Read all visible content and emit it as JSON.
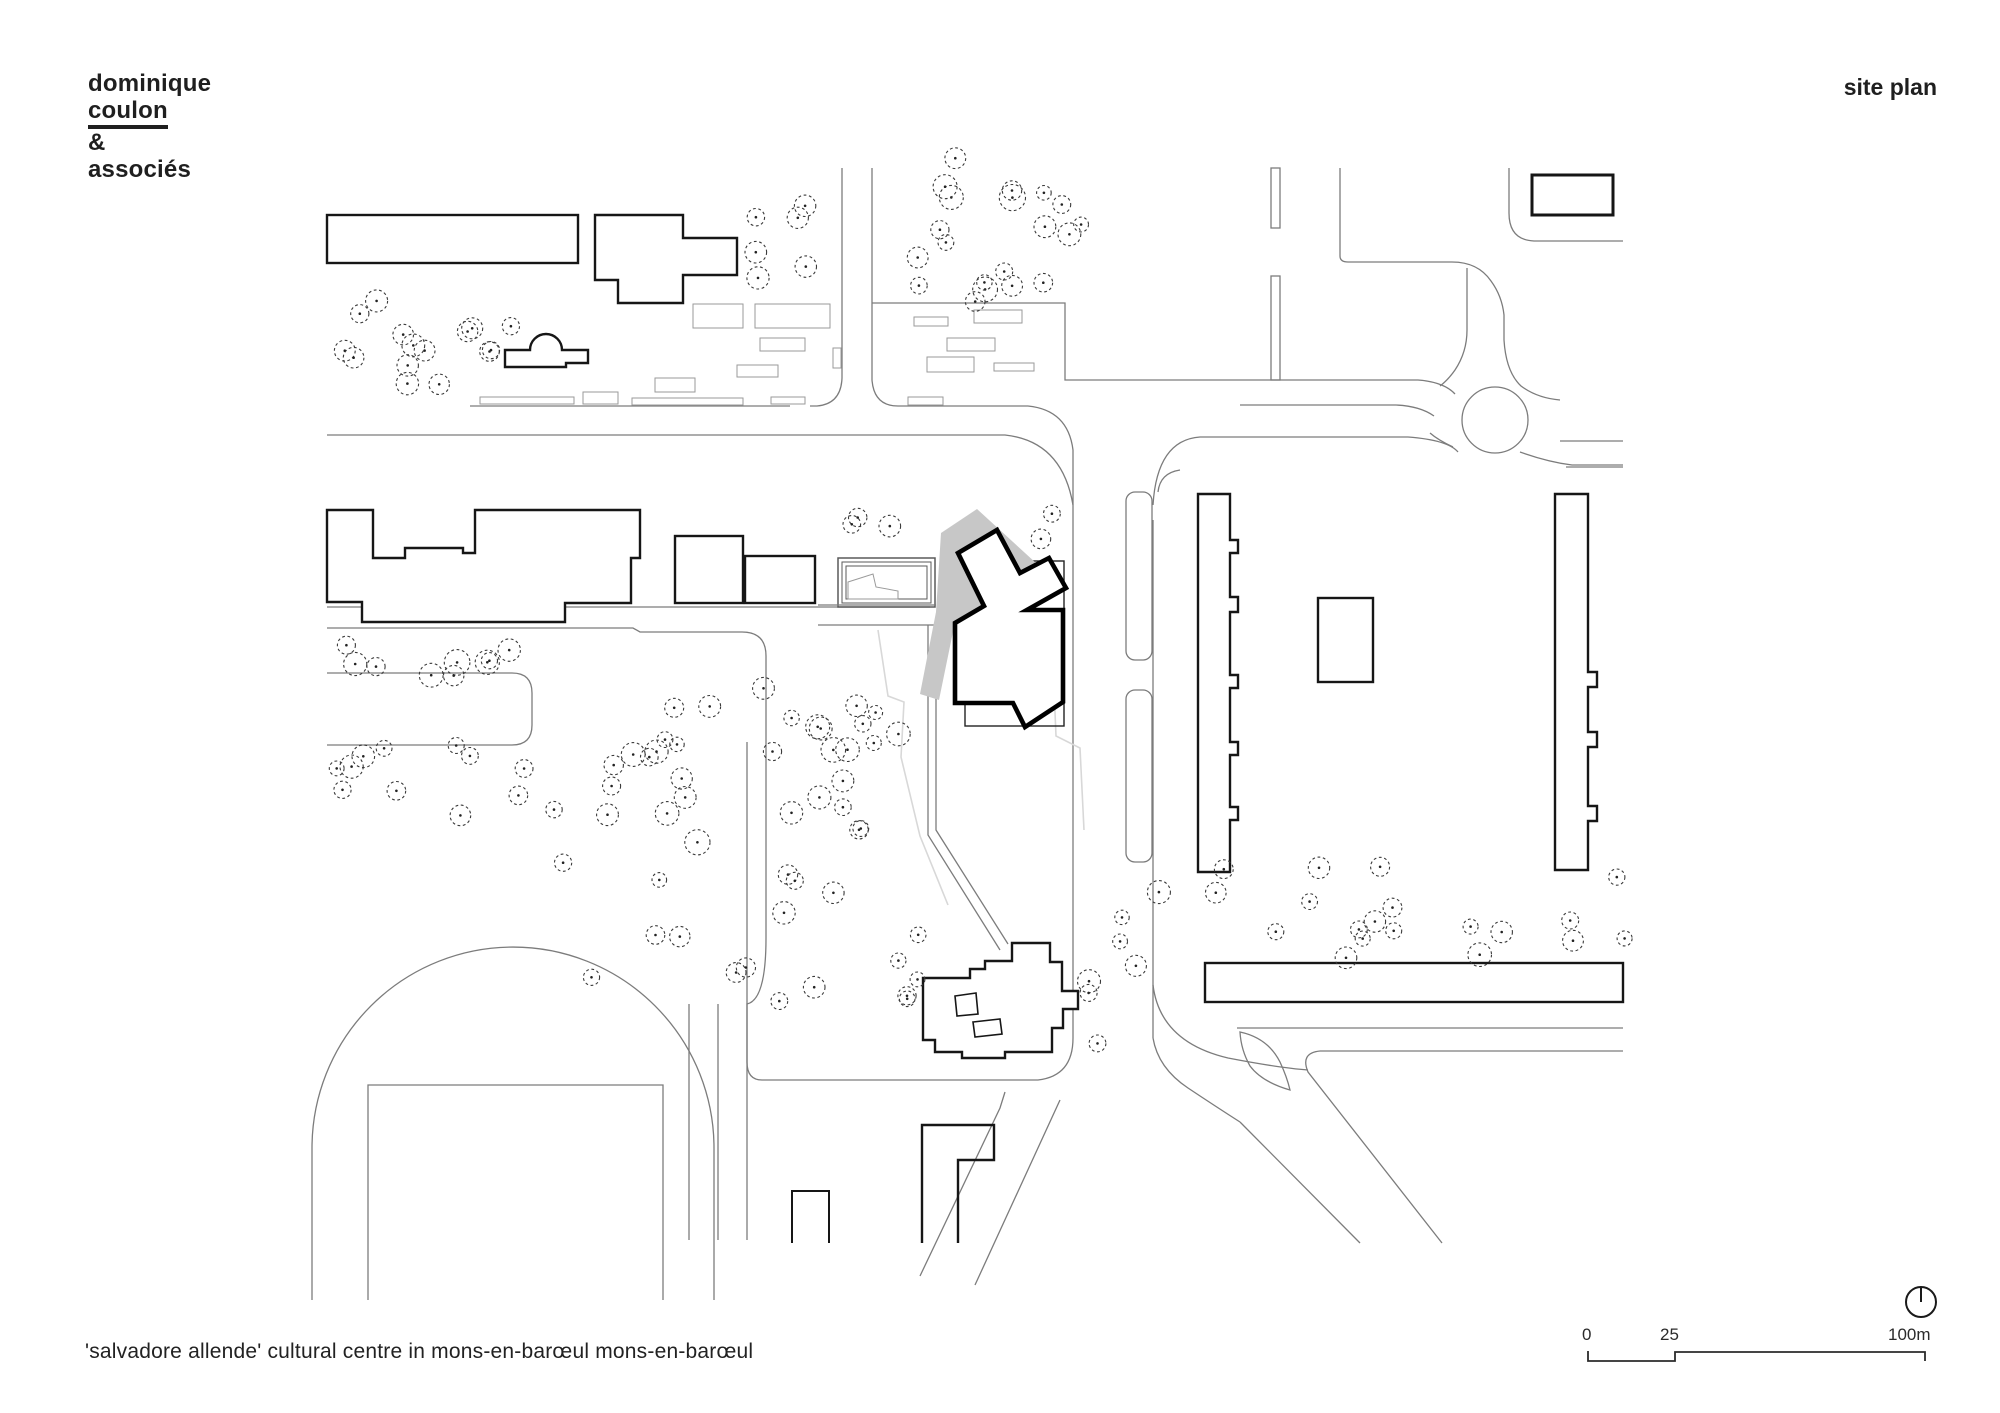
{
  "header": {
    "firm_line1": "dominique",
    "firm_line2": "coulon",
    "firm_line3": "&",
    "firm_line4": "associés",
    "sheet_title": "site plan"
  },
  "footer": {
    "caption": "'salvadore allende' cultural centre in mons-en-barœul mons-en-barœul"
  },
  "scale_bar": {
    "labels": [
      "0",
      "25",
      "100m"
    ]
  },
  "colors": {
    "ink": "#000000",
    "building_line": "#161616",
    "road_line": "#7c7c7c",
    "furniture_line": "#9a9a9a",
    "tree_line": "#3a3a3a",
    "shadow_fill": "#c7c7c7",
    "light_line": "#d8d8d8",
    "paper": "#ffffff"
  },
  "plan": {
    "highlight_building": "salvadore-allende-cultural-centre",
    "tree_clusters": [
      {
        "x": 330,
        "y": 295,
        "w": 185,
        "h": 105,
        "n": 13,
        "rmin": 8,
        "rmax": 12,
        "seed": 11
      },
      {
        "x": 478,
        "y": 330,
        "w": 30,
        "h": 45,
        "n": 2,
        "rmin": 8,
        "rmax": 10,
        "seed": 21
      },
      {
        "x": 752,
        "y": 168,
        "w": 80,
        "h": 118,
        "n": 6,
        "rmin": 7,
        "rmax": 12,
        "seed": 31
      },
      {
        "x": 912,
        "y": 158,
        "w": 185,
        "h": 150,
        "n": 20,
        "rmin": 7,
        "rmax": 14,
        "seed": 41
      },
      {
        "x": 843,
        "y": 515,
        "w": 100,
        "h": 35,
        "n": 3,
        "rmin": 8,
        "rmax": 11,
        "seed": 51
      },
      {
        "x": 1008,
        "y": 512,
        "w": 60,
        "h": 38,
        "n": 2,
        "rmin": 8,
        "rmax": 10,
        "seed": 61
      },
      {
        "x": 330,
        "y": 645,
        "w": 235,
        "h": 32,
        "n": 9,
        "rmin": 7,
        "rmax": 14,
        "seed": 71
      },
      {
        "x": 323,
        "y": 745,
        "w": 240,
        "h": 75,
        "n": 12,
        "rmin": 7,
        "rmax": 12,
        "seed": 81
      },
      {
        "x": 560,
        "y": 748,
        "w": 110,
        "h": 230,
        "n": 8,
        "rmin": 7,
        "rmax": 12,
        "seed": 91
      },
      {
        "x": 650,
        "y": 688,
        "w": 220,
        "h": 325,
        "n": 30,
        "rmin": 7,
        "rmax": 13,
        "seed": 101
      },
      {
        "x": 1085,
        "y": 858,
        "w": 545,
        "h": 100,
        "n": 22,
        "rmin": 7,
        "rmax": 12,
        "seed": 111
      },
      {
        "x": 838,
        "y": 685,
        "w": 125,
        "h": 100,
        "n": 7,
        "rmin": 7,
        "rmax": 12,
        "seed": 121
      },
      {
        "x": 1085,
        "y": 960,
        "w": 65,
        "h": 85,
        "n": 4,
        "rmin": 8,
        "rmax": 12,
        "seed": 131
      },
      {
        "x": 885,
        "y": 918,
        "w": 42,
        "h": 100,
        "n": 5,
        "rmin": 7,
        "rmax": 10,
        "seed": 141
      }
    ]
  }
}
